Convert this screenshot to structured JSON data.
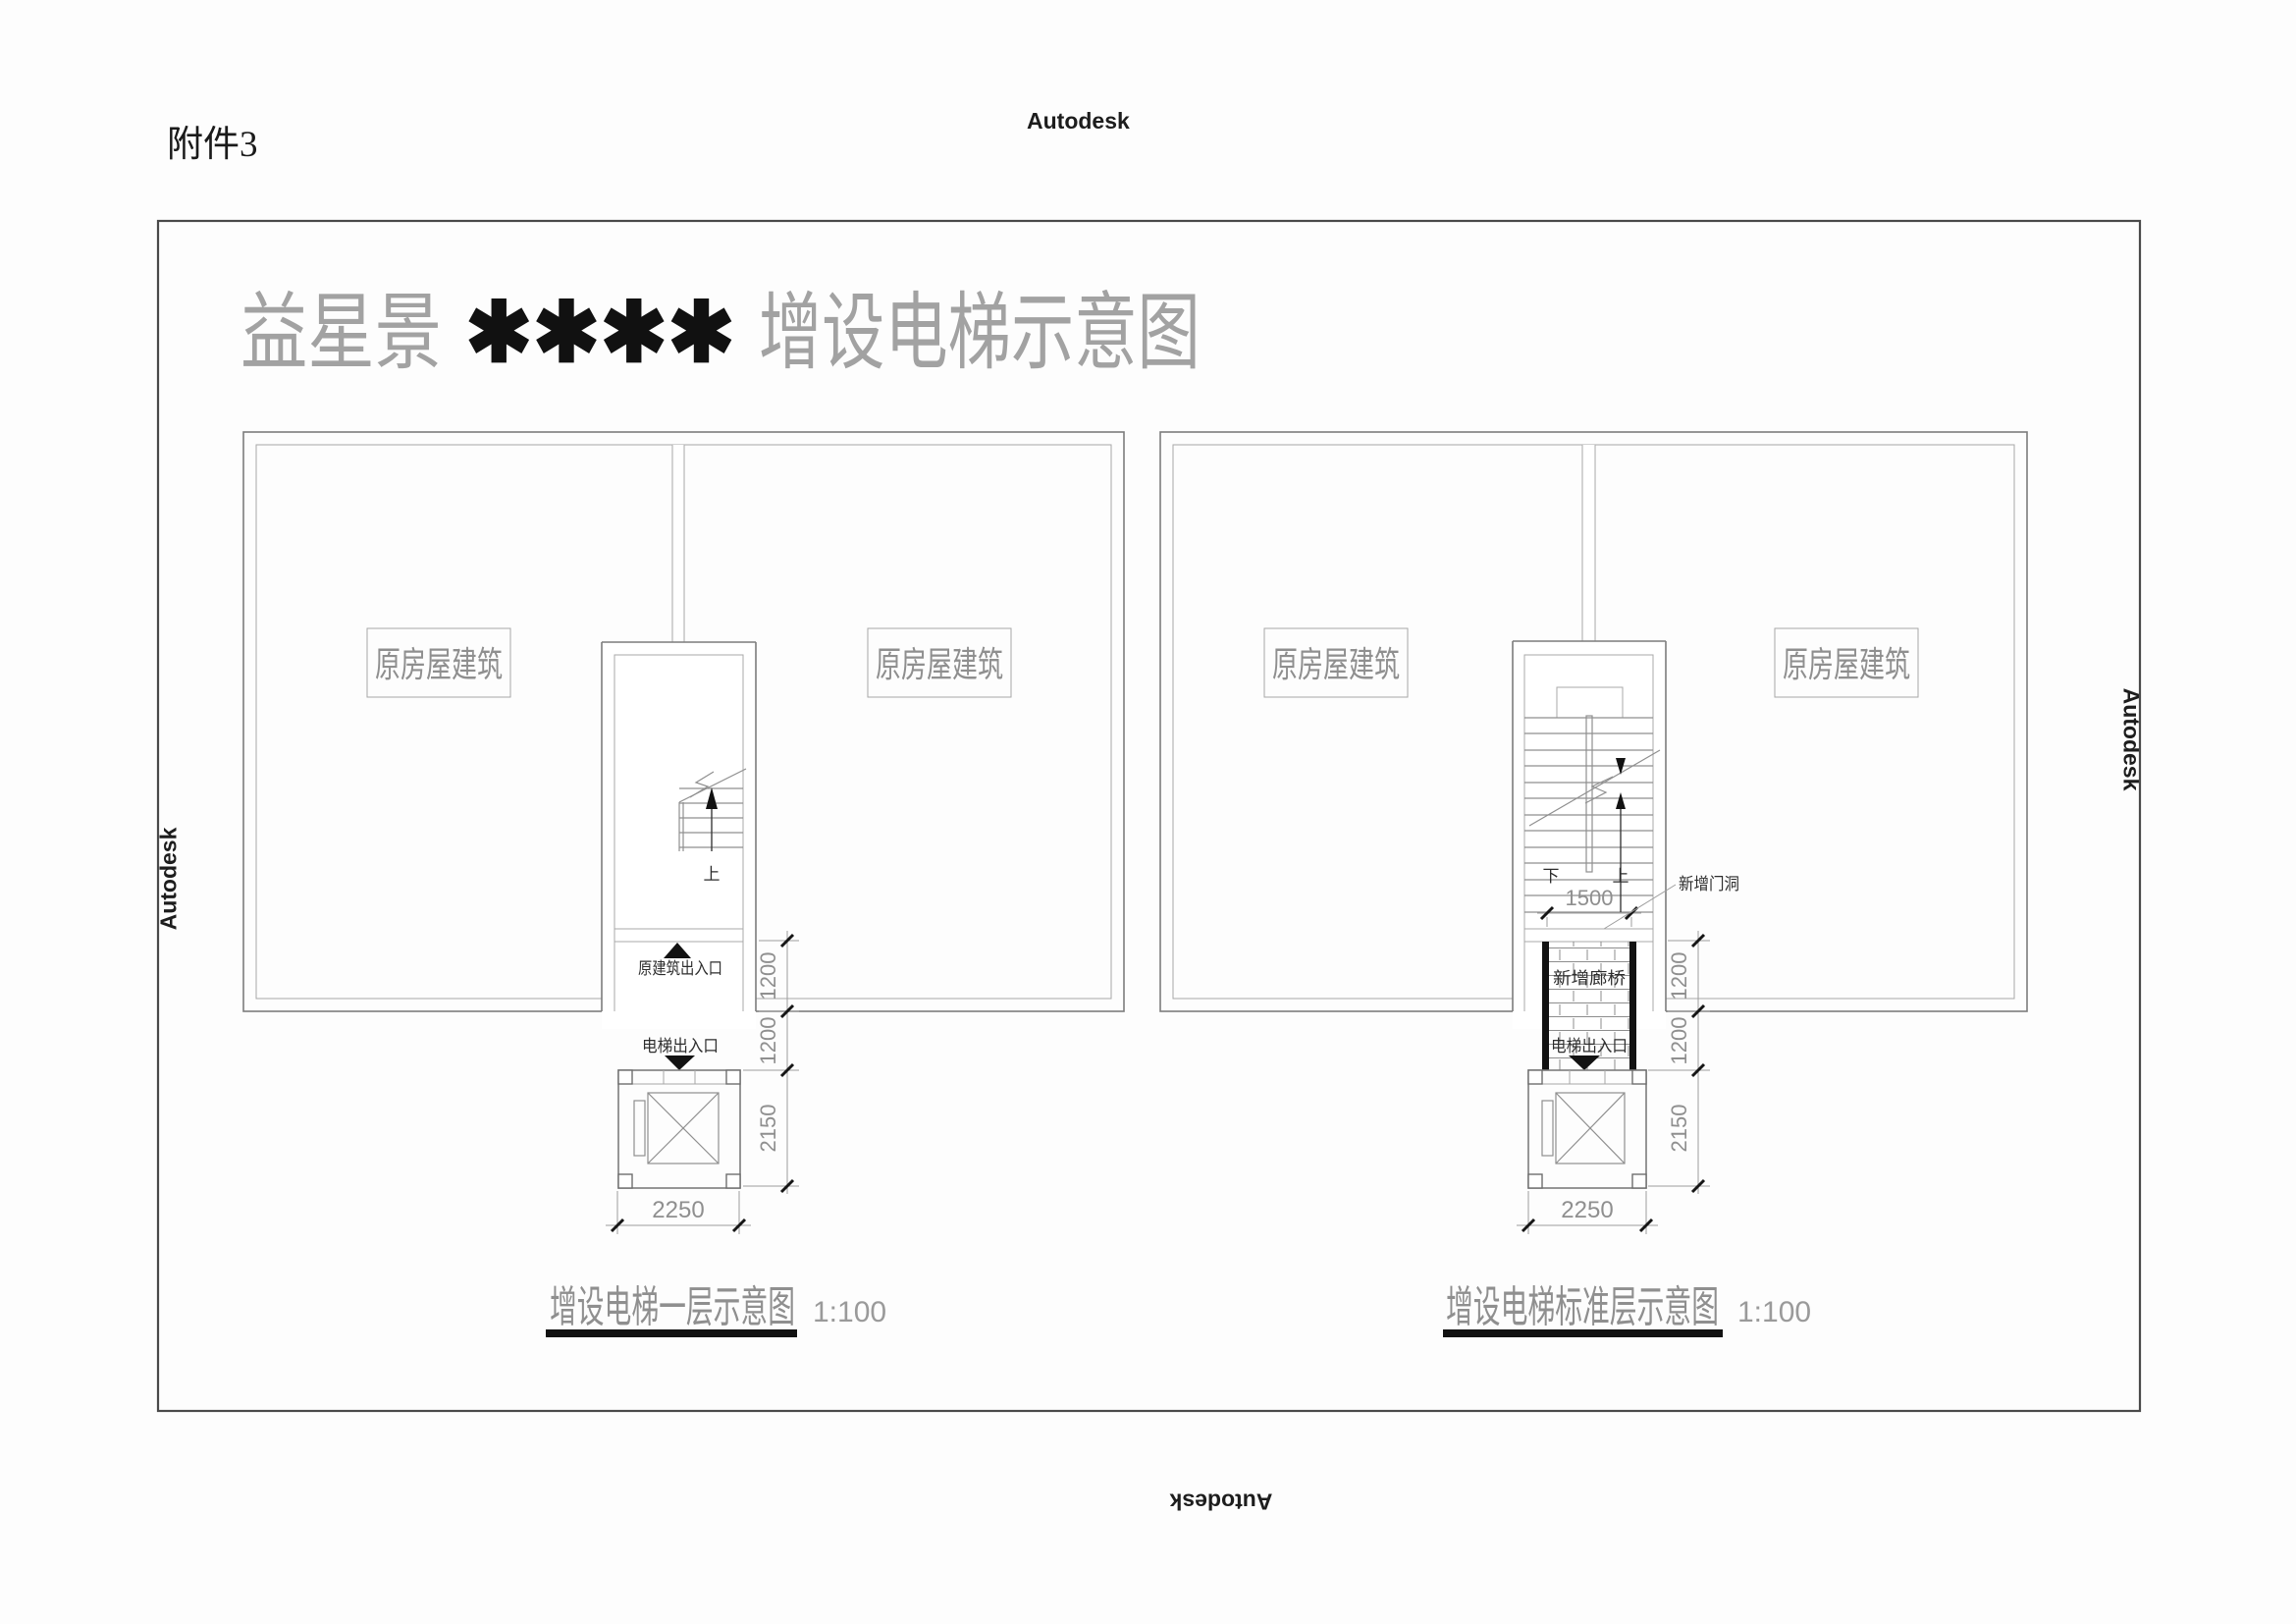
{
  "page": {
    "attachment": "附件3",
    "title_prefix": "益星景",
    "title_censored": "✱✱✱✱",
    "title_suffix": "增设电梯示意图",
    "colors": {
      "cad_gray": "#8f8f8f",
      "hatch_gray": "#b9b9b9",
      "accent_black": "#121212"
    }
  },
  "watermarks": {
    "top": "Autodesk",
    "left": "Autodesk",
    "right": "Autodesk",
    "bottom": "Autodesk"
  },
  "plan_first_floor": {
    "caption": "增设电梯一层示意图",
    "scale": "1:100",
    "building_label_left": "原房屋建筑",
    "building_label_right": "原房屋建筑",
    "stair_up": "上",
    "entrance_label": "原建筑出入口",
    "elevator_entrance": "电梯出入口",
    "dim_entry_depth": "1200",
    "dim_walk_depth": "1200",
    "dim_elevator_depth": "2150",
    "dim_elevator_width": "2250"
  },
  "plan_standard_floor": {
    "caption": "增设电梯标准层示意图",
    "scale": "1:100",
    "building_label_left": "原房屋建筑",
    "building_label_right": "原房屋建筑",
    "stair_up": "上",
    "stair_down": "下",
    "dim_stair_width": "1500",
    "door_opening_label": "新增门洞",
    "corridor_label": "新增廊桥",
    "elevator_entrance": "电梯出入口",
    "dim_entry_depth": "1200",
    "dim_walk_depth": "1200",
    "dim_elevator_depth": "2150",
    "dim_elevator_width": "2250"
  }
}
